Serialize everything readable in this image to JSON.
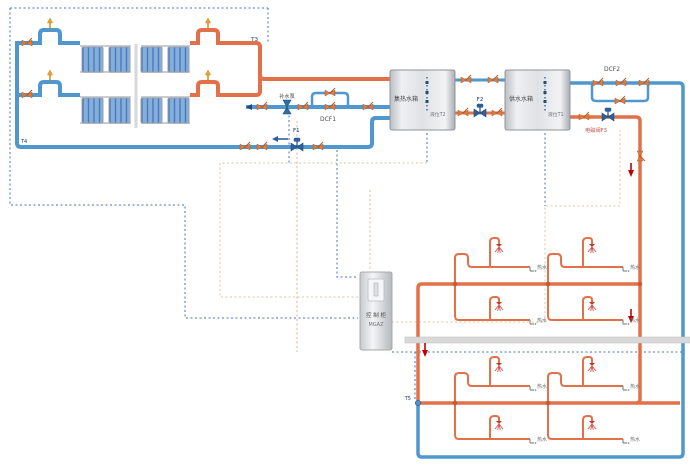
{
  "diagram": {
    "tanks": {
      "collector_tank": "集热水箱",
      "supply_tank": "供水水箱",
      "collector_tank_sensor": "液位T2",
      "supply_tank_sensor": "液位T1"
    },
    "valves": {
      "f1": "F1",
      "f2": "F2",
      "f3": "电磁阀F3",
      "dcf1": "DCF1",
      "dcf2": "DCF2"
    },
    "sensors": {
      "t3": "T3",
      "t4": "T4",
      "t5": "T5"
    },
    "pump_label": "补水泵",
    "cabinet": {
      "line1": "控 制 柜",
      "line2": "MGAZ"
    },
    "tap_label": "热水",
    "colors": {
      "hot_pipe": "#E2714A",
      "cold_pipe": "#4E97CF",
      "hand_valve": "#E07B39",
      "motor_valve": "#2E5FA3",
      "flow_arrow": "#C00000",
      "wiring_blue": "#4472C4",
      "wiring_tan": "#E3C6A0",
      "wiring_pink": "#F0A8A2",
      "wiring_orange": "#F4B183",
      "collector_panel": "#85AEDD"
    },
    "icons": {
      "hand-valve-icon": "bowtie",
      "motor-valve-icon": "bowtie-with-actuator",
      "air-vent-icon": "up-arrow-stem",
      "pump-icon": "vertical-hourglass",
      "shower-head-icon": "spray-fan",
      "tap-icon": "faucet-L",
      "flow-arrow-icon": "down-triangle",
      "level-sensor-icon": "dotted-probe"
    }
  }
}
